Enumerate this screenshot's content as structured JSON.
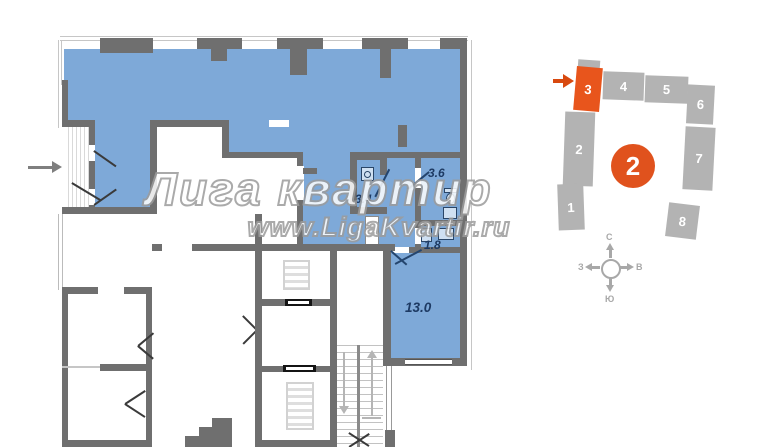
{
  "watermark": {
    "title": "Лига квартир",
    "url": "www.LigaKvartir.ru"
  },
  "floor_plan": {
    "rooms": [
      {
        "label": "3.4"
      },
      {
        "label": "3.6"
      },
      {
        "label": "1.8"
      },
      {
        "label": "13.0"
      }
    ],
    "icons": [
      "entry-arrow-icon",
      "washing-machine-icon",
      "toilet-icon",
      "sink-icon",
      "elevator-icon",
      "staircase-icon",
      "door-swing-icon",
      "window"
    ],
    "colors": {
      "apartment_fill": "#7ea9d8",
      "wall": "#6f6f6f",
      "label": "#1d3a63"
    }
  },
  "building_map": {
    "building_number": "2",
    "sections": [
      {
        "number": "1",
        "highlighted": false
      },
      {
        "number": "2",
        "highlighted": false
      },
      {
        "number": "3",
        "highlighted": true
      },
      {
        "number": "4",
        "highlighted": false
      },
      {
        "number": "5",
        "highlighted": false
      },
      {
        "number": "6",
        "highlighted": false
      },
      {
        "number": "7",
        "highlighted": false
      },
      {
        "number": "8",
        "highlighted": false
      }
    ],
    "compass": {
      "north": "С",
      "south": "Ю",
      "west": "З",
      "east": "В"
    },
    "colors": {
      "highlight": "#e8551c",
      "section": "#b3b3b3"
    }
  }
}
